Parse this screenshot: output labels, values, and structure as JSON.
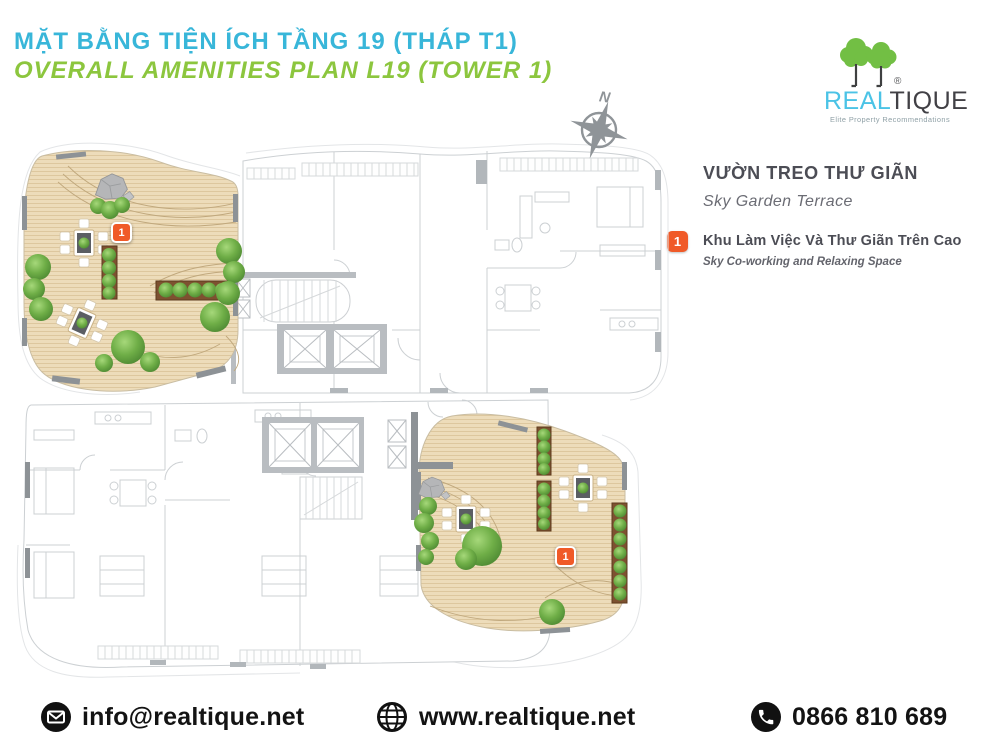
{
  "header": {
    "title_vi": "MẶT BẰNG TIỆN ÍCH TẦNG 19 (THÁP T1)",
    "title_en": "OVERALL AMENITIES PLAN L19 (TOWER 1)"
  },
  "logo": {
    "brand_primary": "REAL",
    "brand_secondary": "TIQUE",
    "registered": "®",
    "tagline": "Elite Property Recommendations"
  },
  "compass": {
    "label": "N"
  },
  "legend": {
    "heading_vi": "VƯỜN TREO THƯ GIÃN",
    "heading_en": "Sky Garden Terrace",
    "items": [
      {
        "number": "1",
        "label_vi": "Khu Làm Việc Và Thư Giãn Trên Cao",
        "label_en": "Sky Co-working and Relaxing Space"
      }
    ]
  },
  "plan": {
    "markers": [
      {
        "number": "1",
        "location": "north-west sky garden terrace"
      },
      {
        "number": "1",
        "location": "south-east sky garden terrace"
      }
    ]
  },
  "footer": {
    "email": "info@realtique.net",
    "website": "www.realtique.net",
    "phone": "0866 810 689"
  },
  "colors": {
    "accent_blue": "#38b6d9",
    "accent_green": "#8cc63e",
    "marker_orange": "#f05a28",
    "deck_tan": "#eddcba",
    "tree_green": "#6fae47",
    "logo_green": "#72bf44",
    "logo_blue": "#4bc3e6",
    "plan_linework_gray": "#ccd0d3",
    "contact_black": "#131313"
  }
}
